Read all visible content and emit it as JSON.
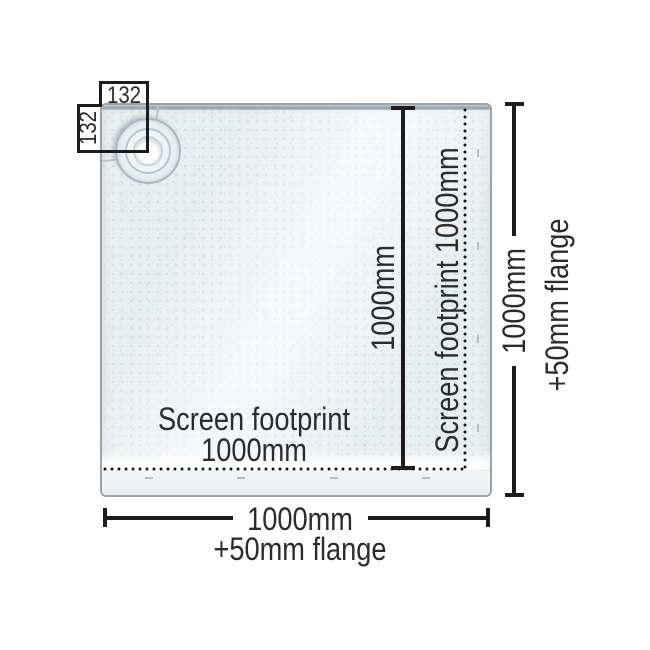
{
  "diagram": {
    "type": "shower-tray dimension drawing",
    "drain_offset_width_label": "132",
    "drain_offset_height_label": "132",
    "inner_height_label": "1000mm",
    "screen_footprint_side_label": "Screen footprint 1000mm",
    "screen_footprint_bottom_line1": "Screen footprint",
    "screen_footprint_bottom_line2": "1000mm",
    "overall_height_label": "1000mm",
    "overall_height_flange_label": "+50mm flange",
    "overall_width_label": "1000mm",
    "overall_width_flange_label": "+50mm flange",
    "colors": {
      "background": "#ffffff",
      "tray_fill": "#e8eff3",
      "tray_texture_dot": "#d3dfe5",
      "tray_border": "#9aa4aa",
      "dimension_line": "#1c1c1c",
      "label_text": "#2c2c2c"
    }
  }
}
